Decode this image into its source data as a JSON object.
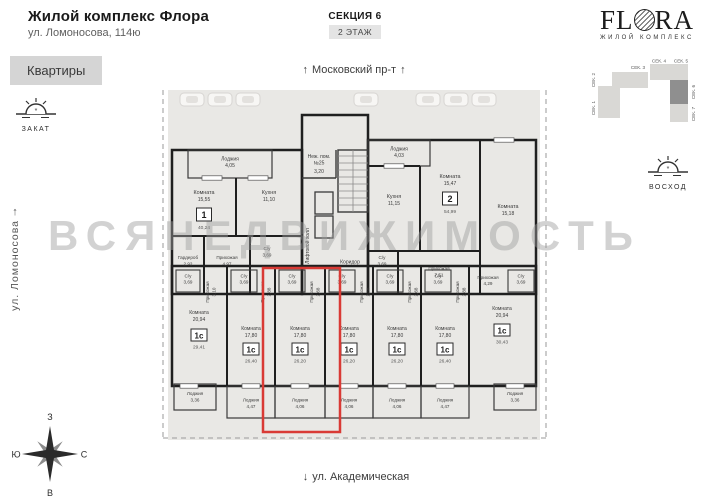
{
  "header": {
    "title": "Жилой комплекс Флора",
    "subtitle": "ул. Ломоносова, 114ю",
    "section_label": "СЕКЦИЯ 6",
    "floor_label": "2 ЭТАЖ"
  },
  "logo": {
    "brand_start": "FL",
    "brand_end": "RA",
    "tagline": "ЖИЛОЙ КОМПЛЕКС"
  },
  "sidebar": {
    "apartments_button": "Квартиры"
  },
  "orientation": {
    "sunset_label": "ЗАКАТ",
    "sunrise_label": "ВОСХОД",
    "street_left": "ул. Ломоносова",
    "street_top": "Московский пр-т",
    "street_bottom": "ул. Академическая",
    "arrow_up": "↑",
    "arrow_down": "↓",
    "compass": {
      "top": "З",
      "left": "Ю",
      "right": "С",
      "bottom": "В"
    }
  },
  "site_map": {
    "sec1": "СЕК. 1",
    "sec2": "СЕК. 2",
    "sec3": "СЕК. 3",
    "sec4": "СЕК. 4",
    "sec5": "СЕК. 5",
    "sec6": "СЕК. 6",
    "sec7": "СЕК. 7",
    "active": "СЕК. 6"
  },
  "watermark": "ВСЯНЕДВИЖИМОСТЬ",
  "colors": {
    "highlight_red": "#d93a35",
    "section_active": "#8f8f8f"
  },
  "floor_plan": {
    "common": {
      "non_residential_1": "Неж. пом.",
      "non_residential_2": "№25",
      "non_residential_area": "3,20",
      "lift_hall": "Лифтовой холл",
      "corridor": "Коридор"
    },
    "apartments": [
      {
        "type": "1",
        "total": "40,24",
        "rooms": {
          "room": {
            "name": "Комната",
            "area": "15,55"
          },
          "kitchen": {
            "name": "Кухня",
            "area": "11,10"
          },
          "wardrobe": {
            "name": "Гардероб",
            "area": "2,92"
          },
          "hall": {
            "name": "Прихожая",
            "area": "4,97"
          },
          "bath": {
            "name": "С/у",
            "area": "3,69"
          },
          "loggia": {
            "name": "Лоджия",
            "area": "4,05"
          }
        }
      },
      {
        "type": "2",
        "total": "54,99",
        "rooms": {
          "room1": {
            "name": "Комната",
            "area": "15,47"
          },
          "room2": {
            "name": "Комната",
            "area": "15,18"
          },
          "kitchen": {
            "name": "Кухня",
            "area": "11,15"
          },
          "hall": {
            "name": "Прихожая",
            "area": "7,51"
          },
          "bath": {
            "name": "С/у",
            "area": "3,69"
          },
          "loggia": {
            "name": "Лоджия",
            "area": "4,03"
          }
        }
      },
      {
        "type": "1с",
        "total": "29,41",
        "rooms": {
          "room": {
            "name": "Комната",
            "area": "20,94"
          },
          "bath": {
            "name": "С/у",
            "area": "3,69"
          },
          "hall": {
            "name": "Прихожая",
            "area": "3,10"
          },
          "loggia": {
            "name": "Лоджия",
            "area": "3,36"
          }
        }
      },
      {
        "type": "1с",
        "total": "26,40",
        "rooms": {
          "room": {
            "name": "Комната",
            "area": "17,80"
          },
          "bath": {
            "name": "С/у",
            "area": "3,69"
          },
          "hall": {
            "name": "Прихожая",
            "area": "2,88"
          },
          "loggia": {
            "name": "Лоджия",
            "area": "4,47"
          }
        }
      },
      {
        "type": "1с",
        "total": "26,20",
        "highlighted": true,
        "rooms": {
          "room": {
            "name": "Комната",
            "area": "17,80"
          },
          "bath": {
            "name": "С/у",
            "area": "3,69"
          },
          "hall": {
            "name": "Прихожая",
            "area": "2,68"
          },
          "loggia": {
            "name": "Лоджия",
            "area": "4,06"
          }
        }
      },
      {
        "type": "1с",
        "total": "26,20",
        "rooms": {
          "room": {
            "name": "Комната",
            "area": "17,80"
          },
          "bath": {
            "name": "С/у",
            "area": "3,69"
          },
          "hall": {
            "name": "Прихожая",
            "area": "2,68"
          },
          "loggia": {
            "name": "Лоджия",
            "area": "4,06"
          }
        }
      },
      {
        "type": "1с",
        "total": "26,20",
        "rooms": {
          "room": {
            "name": "Комната",
            "area": "17,80"
          },
          "bath": {
            "name": "С/у",
            "area": "3,69"
          },
          "hall": {
            "name": "Прихожая",
            "area": "2,68"
          },
          "loggia": {
            "name": "Лоджия",
            "area": "4,06"
          }
        }
      },
      {
        "type": "1с",
        "total": "26,40",
        "rooms": {
          "room": {
            "name": "Комната",
            "area": "17,80"
          },
          "bath": {
            "name": "С/у",
            "area": "3,69"
          },
          "hall": {
            "name": "Прихожая",
            "area": "2,88"
          },
          "loggia": {
            "name": "Лоджия",
            "area": "4,47"
          }
        }
      },
      {
        "type": "1с",
        "total": "30,43",
        "rooms": {
          "room": {
            "name": "Комната",
            "area": "20,94"
          },
          "hall": {
            "name": "Прихожая",
            "area": "4,29"
          },
          "bath": {
            "name": "С/у",
            "area": "3,69"
          },
          "loggia": {
            "name": "Лоджия",
            "area": "3,36"
          }
        }
      }
    ]
  }
}
